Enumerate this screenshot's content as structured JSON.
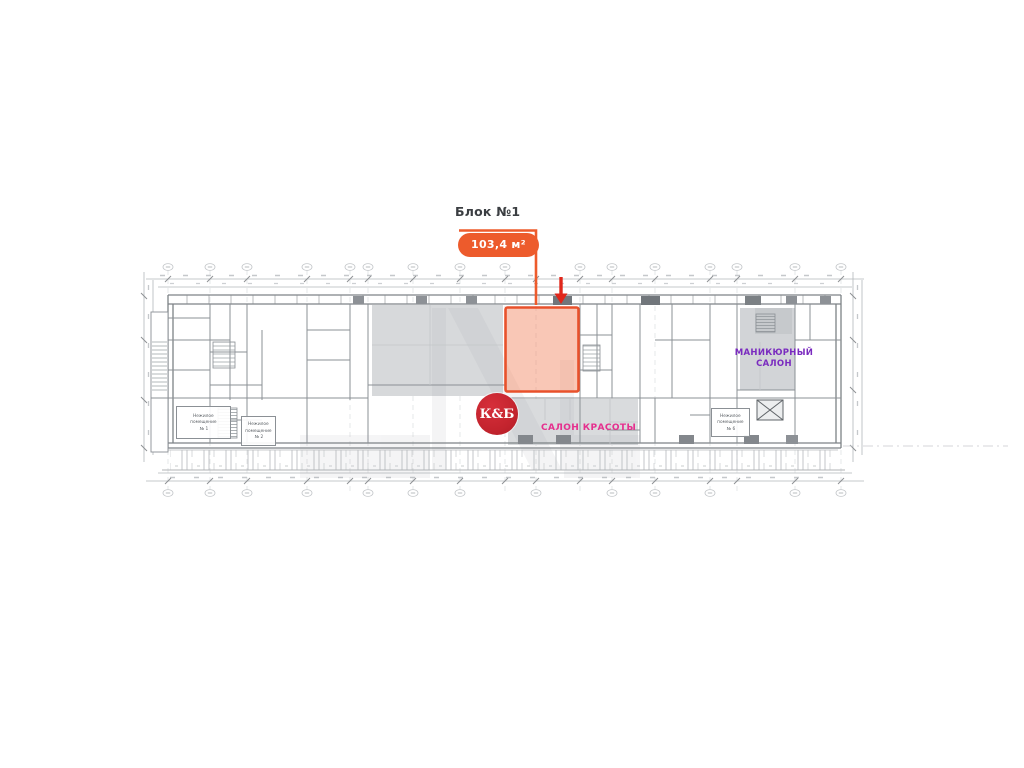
{
  "callout": {
    "title": "Блок №1",
    "area": "103,4 м²"
  },
  "tenants": {
    "kb": "К&Б",
    "beauty": "САЛОН КРАСОТЫ",
    "manicure1": "МАНИКЮРНЫЙ",
    "manicure2": "САЛОН"
  },
  "rooms": {
    "r1": {
      "l1": "Нежилое",
      "l2": "помещение",
      "l3": "№ 1"
    },
    "r2": {
      "l1": "Нежилое",
      "l2": "помещение",
      "l3": "№ 2"
    },
    "r6": {
      "l1": "Нежилое",
      "l2": "помещение",
      "l3": "№ 6"
    }
  },
  "colors": {
    "accent_orange": "#ED5B2C",
    "arrow_red": "#E0271B",
    "kb_red": "#C4242E",
    "beauty_pink": "#E5308E",
    "manicure_purple": "#7A2BBF",
    "highlight_fill": "#F07A50",
    "plan_line_gray": "#8b9095",
    "room_shade_gray": "#d7d9db"
  }
}
